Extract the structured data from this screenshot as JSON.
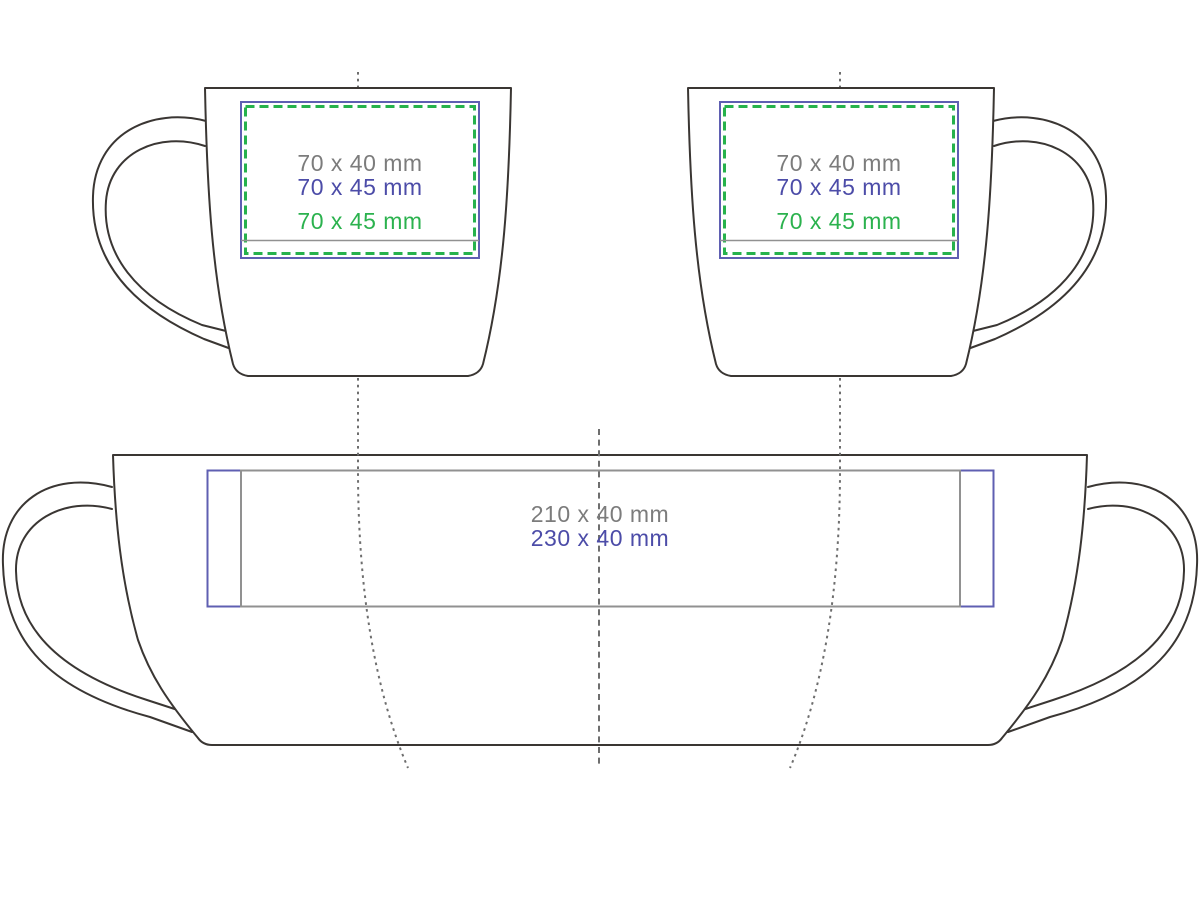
{
  "colors": {
    "background": "#ffffff",
    "outline": "#3a3633",
    "guide": "#6e6e6e",
    "area_gray": "#919191",
    "area_blue": "#5f5fb2",
    "area_green": "#27b24c",
    "text_gray": "#7c7c7c",
    "text_blue": "#4c4ca8",
    "text_green": "#2bb24e"
  },
  "views": {
    "front_left": {
      "title": "mug front view, handle left",
      "labels": [
        {
          "text": "70 x 40 mm",
          "zone": "gray"
        },
        {
          "text": "70 x 45 mm",
          "zone": "blue"
        },
        {
          "text": "70 x 45 mm",
          "zone": "green"
        }
      ]
    },
    "front_right": {
      "title": "mug front view, handle right",
      "labels": [
        {
          "text": "70 x 40 mm",
          "zone": "gray"
        },
        {
          "text": "70 x 45 mm",
          "zone": "blue"
        },
        {
          "text": "70 x 45 mm",
          "zone": "green"
        }
      ]
    },
    "wrap": {
      "title": "mug unwrapped full-wrap view",
      "labels": [
        {
          "text": "210 x 40 mm",
          "zone": "gray"
        },
        {
          "text": "230 x 40 mm",
          "zone": "blue"
        }
      ]
    }
  }
}
